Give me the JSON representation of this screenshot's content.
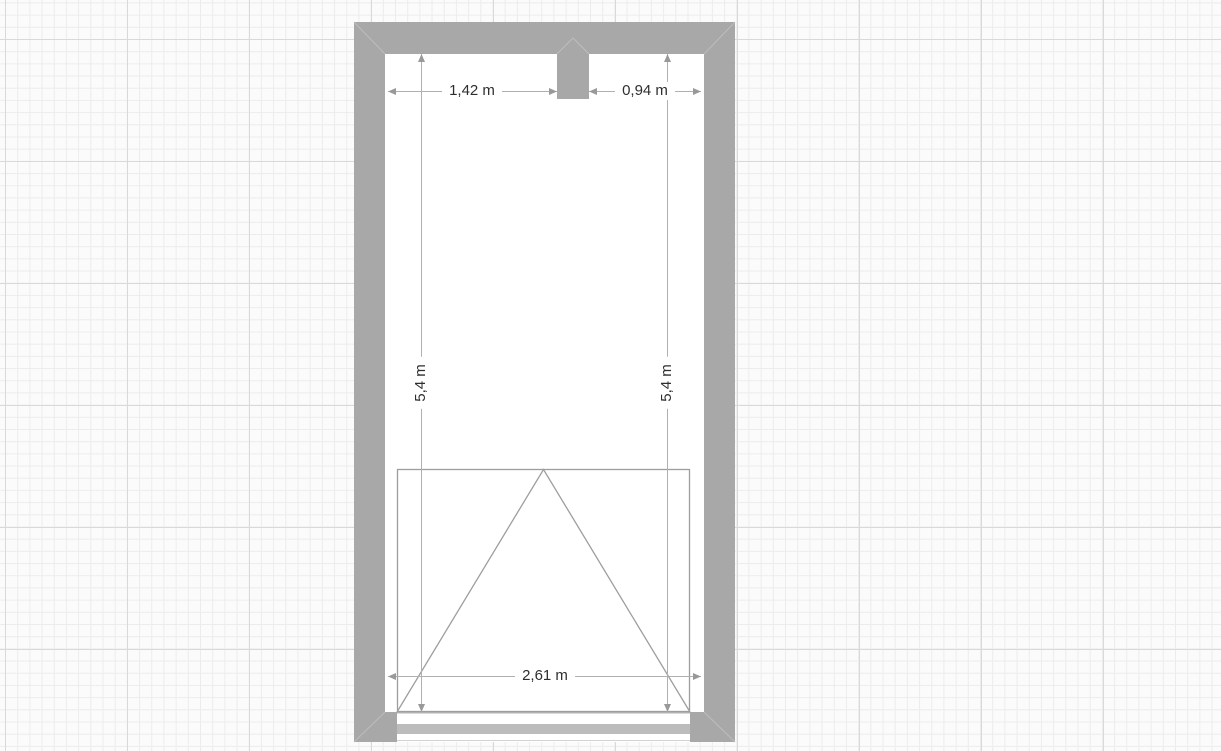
{
  "plan": {
    "unit": "m",
    "dimensions": {
      "top_left": {
        "label": "1,42 m",
        "orientation": "horizontal"
      },
      "top_right": {
        "label": "0,94 m",
        "orientation": "horizontal"
      },
      "left_side": {
        "label": "5,4 m",
        "orientation": "vertical"
      },
      "right_side": {
        "label": "5,4 m",
        "orientation": "vertical"
      },
      "bottom": {
        "label": "2,61 m",
        "orientation": "horizontal"
      }
    },
    "colors": {
      "background": "#fbfbfb",
      "grid_minor": "#ececec",
      "grid_major": "#d9d9d9",
      "wall": "#a8a8a8",
      "wall_miter": "#bdbdbd",
      "room_floor": "#ffffff",
      "door_symbol_line": "#9e9e9e",
      "door_frame_line": "#b3b3b3",
      "door_panel": "#bcbcbc",
      "dimension_line": "#b0b0b0",
      "dimension_arrow": "#999999",
      "dimension_text": "#2e2e2e"
    }
  }
}
